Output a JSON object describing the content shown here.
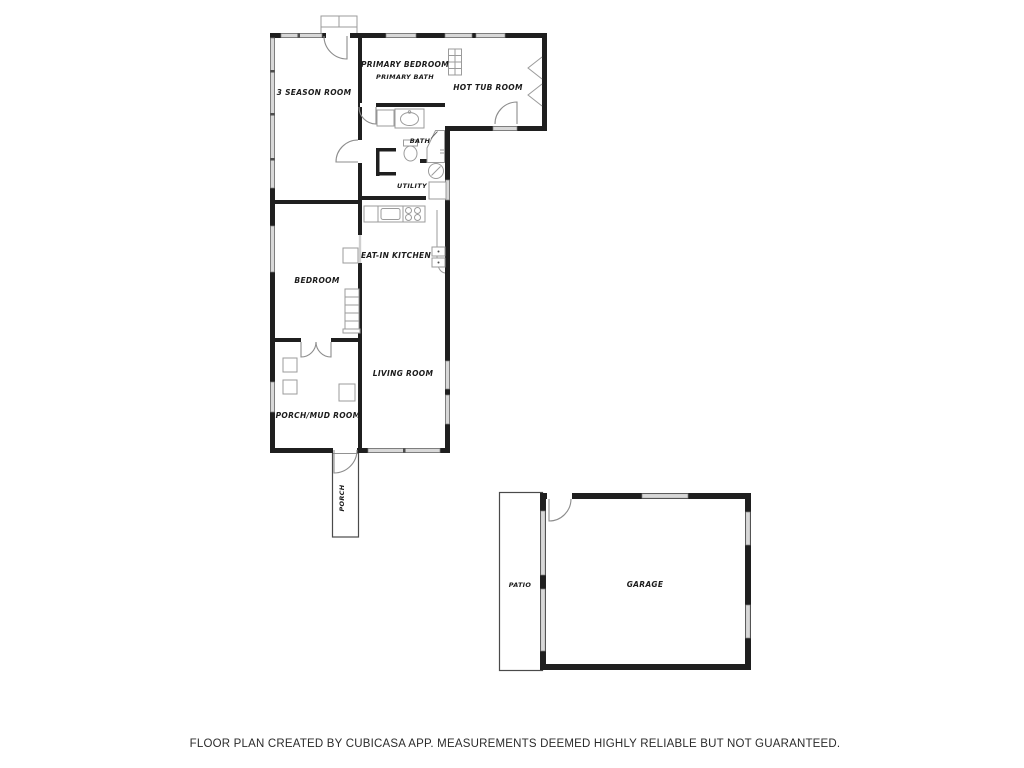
{
  "rooms": {
    "three_season": {
      "label": "3 SEASON ROOM"
    },
    "primary_bedroom": {
      "label": "PRIMARY BEDROOM"
    },
    "primary_bath": {
      "label": "PRIMARY BATH"
    },
    "hot_tub": {
      "label": "HOT TUB ROOM"
    },
    "bath": {
      "label": "BATH"
    },
    "utility": {
      "label": "UTILITY"
    },
    "kitchen": {
      "label": "EAT-IN KITCHEN"
    },
    "bedroom": {
      "label": "BEDROOM"
    },
    "living": {
      "label": "LIVING ROOM"
    },
    "mud_room": {
      "label": "PORCH/MUD ROOM"
    },
    "porch": {
      "label": "PORCH"
    },
    "patio": {
      "label": "PATIO"
    },
    "garage": {
      "label": "GARAGE"
    }
  },
  "footer": {
    "disclaimer": "FLOOR PLAN CREATED BY CUBICASA APP. MEASUREMENTS DEEMED HIGHLY RELIABLE BUT NOT GUARANTEED."
  },
  "colors": {
    "wall": "#1f1f1f",
    "window-fill": "#d8d8d8",
    "window-stroke": "#7f7f7f",
    "fixture": "#9b9b9b",
    "door": "#8c8c8c",
    "outline": "#4a4a4a",
    "label": "#1c1c1c",
    "footer": "#2b2b2b"
  }
}
